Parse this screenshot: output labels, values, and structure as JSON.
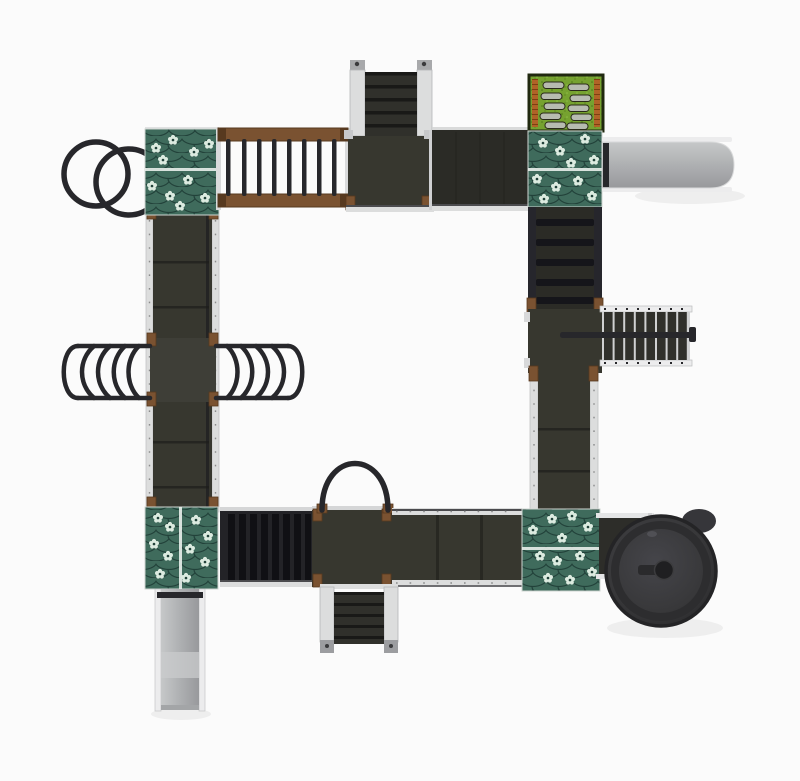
{
  "scene": {
    "title": "Playground structure — top view render",
    "description": "Top-down render of a modular playground: a square circuit of dark elevated walkways with four teal shingled tower roofs, monkey bars, three stair runs, two straight grey slides, a spiral slide, a double ring climber, two wave-rung climbers, a cleated ramp and a green rooftop activity panel.",
    "colors": {
      "background": "#fbfbfb",
      "bar": "#27272b",
      "wood": "#7a5231",
      "woodDark": "#57391f",
      "deck": "#37372f",
      "deckDark": "#2b2b26",
      "deckSeam": "#1e1e1b",
      "step": "#30302b",
      "stepDark": "#191917",
      "railLight": "#dcdddd",
      "railShade": "#b9babc",
      "railWhite": "#ececed",
      "roofBase": "#2e5448",
      "roofShingle": "#3f6b5c",
      "roofDark": "#22423a",
      "roofRidge": "#e9efeb",
      "flower": "#dcebe0",
      "slideLight": "#c6c8c9",
      "slideMid": "#aeb0b2",
      "slideDark": "#98999c",
      "grass": "#76a230",
      "grassDark": "#4c7417",
      "grassLight": "#8fbf45",
      "brick": "#b06327",
      "brickDark": "#7c3f12",
      "spiral": "#38383a",
      "spiralDark": "#242426",
      "spiralRing": "#2d2d2f",
      "stone": "#b7bbb0"
    },
    "components": [
      {
        "name": "ring-climber",
        "label": "Double ring climber"
      },
      {
        "name": "roof-top-left",
        "label": "Shingled tower roof (top left)"
      },
      {
        "name": "monkey-bars",
        "label": "Horizontal ladder (monkey bars)"
      },
      {
        "name": "stairs-top",
        "label": "Access stairs (top)"
      },
      {
        "name": "platform-top",
        "label": "Deck platform (top)"
      },
      {
        "name": "walkway-top",
        "label": "Elevated walkway (top run)"
      },
      {
        "name": "activity-panel",
        "label": "Rooftop activity panel with stepping stones"
      },
      {
        "name": "roof-top-right",
        "label": "Shingled tower roof (top right)"
      },
      {
        "name": "slide-straight-right",
        "label": "Straight slide (right)"
      },
      {
        "name": "ramp-right",
        "label": "Cleated climbing ramp (right run)"
      },
      {
        "name": "stairs-right",
        "label": "Access stairs with handrail (right)"
      },
      {
        "name": "walkway-right",
        "label": "Elevated walkway (right run)"
      },
      {
        "name": "roof-bottom-right",
        "label": "Shingled tower roof (bottom right)"
      },
      {
        "name": "spiral-slide",
        "label": "Spiral tube slide"
      },
      {
        "name": "walkway-bottom",
        "label": "Elevated walkway (bottom run)"
      },
      {
        "name": "arch-loop",
        "label": "Arch grab loop"
      },
      {
        "name": "stairs-bottom",
        "label": "Access stairs (bottom)"
      },
      {
        "name": "roof-bottom-left",
        "label": "Shingled tower roof (bottom left)"
      },
      {
        "name": "slide-straight-bottom",
        "label": "Straight slide (bottom left)"
      },
      {
        "name": "walkway-left",
        "label": "Elevated walkway (left run)"
      },
      {
        "name": "wave-climber-left",
        "label": "Wave rung climber (outer)"
      },
      {
        "name": "wave-climber-right",
        "label": "Wave rung climber (inner)"
      }
    ]
  }
}
